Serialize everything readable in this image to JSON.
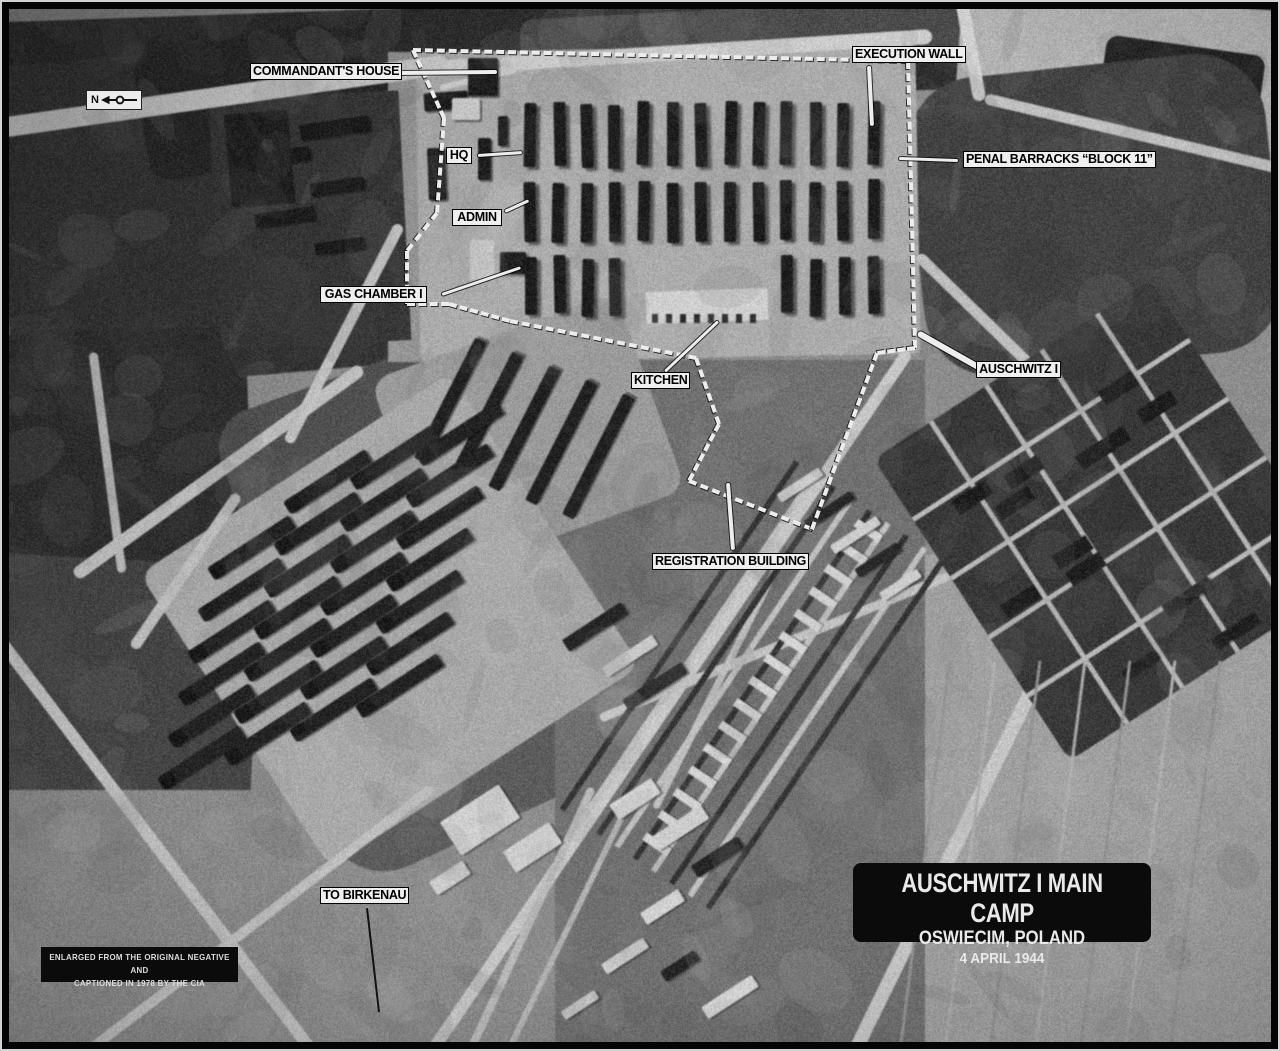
{
  "photo": {
    "compass_letter": "N",
    "labels": [
      {
        "id": "commandants-house",
        "text": "COMMANDANT'S HOUSE"
      },
      {
        "id": "execution-wall",
        "text": "EXECUTION WALL"
      },
      {
        "id": "hq",
        "text": "HQ"
      },
      {
        "id": "admin",
        "text": "ADMIN"
      },
      {
        "id": "gas-chamber-1",
        "text": "GAS CHAMBER I"
      },
      {
        "id": "penal-barracks-block-11",
        "text": "PENAL BARRACKS “BLOCK 11”"
      },
      {
        "id": "kitchen",
        "text": "KITCHEN"
      },
      {
        "id": "auschwitz-1",
        "text": "AUSCHWITZ I"
      },
      {
        "id": "registration-building",
        "text": "REGISTRATION BUILDING"
      },
      {
        "id": "to-birkenau",
        "text": "TO BIRKENAU"
      }
    ],
    "title_box": {
      "line1": "AUSCHWITZ I MAIN CAMP",
      "line2": "OSWIECIM, POLAND",
      "line3": "4 APRIL 1944"
    },
    "credit_box": {
      "line1": "ENLARGED FROM THE ORIGINAL NEGATIVE AND",
      "line2": "CAPTIONED IN 1978 BY THE CIA"
    },
    "colors": {
      "label_bg": "#efefef",
      "label_text": "#000000",
      "annotation_box_bg": "#0b0b0b",
      "annotation_box_text": "#e9e9e9"
    }
  }
}
